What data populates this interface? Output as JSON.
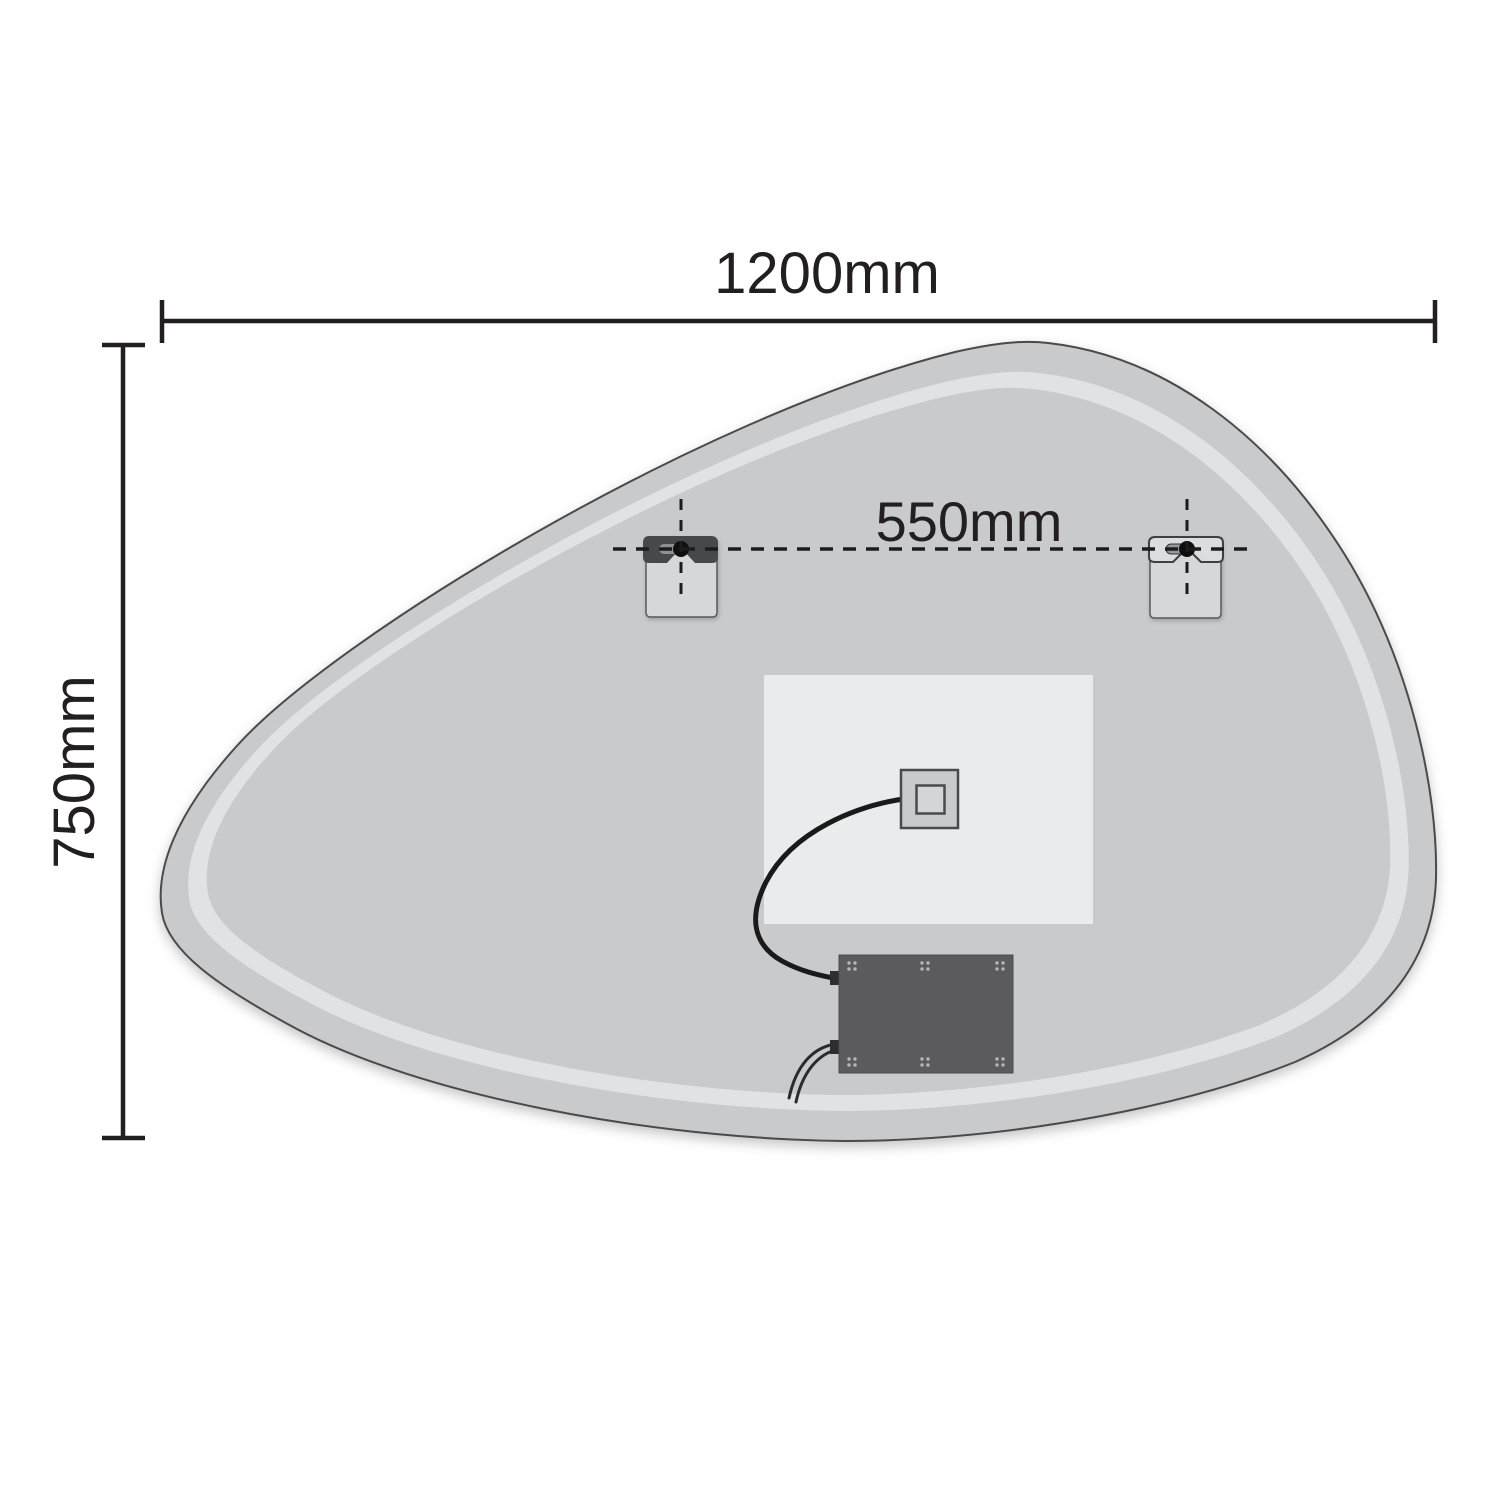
{
  "diagram": {
    "type": "mirror-technical-dimension-drawing",
    "dimensions": {
      "width": {
        "label": "1200mm"
      },
      "height": {
        "label": "750mm"
      },
      "bracket_spacing": {
        "label": "550mm"
      }
    },
    "components": {
      "mirror_back": "organic-pebble-mirror-back",
      "led_ring": "led-light-ring",
      "backing_panel": "backing-panel",
      "left_bracket": "hanging-bracket-left",
      "right_bracket": "hanging-bracket-right",
      "junction_box": "junction-box",
      "driver_box": "led-driver-box",
      "cable": "connection-cable",
      "power_wires": "power-wires"
    },
    "colors": {
      "mirror_body": "#c9cacc",
      "led_ring": "#e1e2e4",
      "backing_panel": "#e9ebec",
      "driver_box": "#5b5b5d",
      "bracket_clip_dark": "#47484a",
      "bracket_plate": "#d6d7d9",
      "edge_outline": "#4a4a4a",
      "dimension_text": "#231f20",
      "cable": "#1a1a1a",
      "keyhole": "#0f0f10"
    }
  }
}
